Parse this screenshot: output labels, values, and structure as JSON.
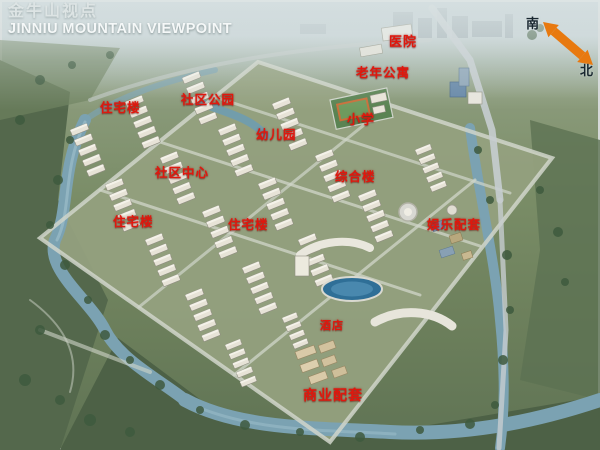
{
  "title": {
    "zh": "金牛山视点",
    "en": "JINNIU MOUNTAIN VIEWPOINT"
  },
  "compass": {
    "south": "南",
    "north": "北",
    "arrow_direction": "northwest-southeast double-headed"
  },
  "colors": {
    "label_red": "#e0170d",
    "arrow_orange": "#e8790f",
    "title_white": "#f5f8f8",
    "water_blue": "#7ba2b2",
    "pond_blue": "#2f6f97"
  },
  "labels": [
    {
      "id": "hospital",
      "text": "医院",
      "x": 389,
      "y": 31
    },
    {
      "id": "senior-apartments",
      "text": "老年公寓",
      "x": 356,
      "y": 62
    },
    {
      "id": "residential-north",
      "text": "住宅楼",
      "x": 100,
      "y": 97
    },
    {
      "id": "community-park",
      "text": "社区公园",
      "x": 181,
      "y": 89
    },
    {
      "id": "kindergarten",
      "text": "幼儿园",
      "x": 256,
      "y": 124
    },
    {
      "id": "elementary-school",
      "text": "小学",
      "x": 347,
      "y": 109
    },
    {
      "id": "community-center",
      "text": "社区中心",
      "x": 155,
      "y": 162
    },
    {
      "id": "mixed-use-building",
      "text": "综合楼",
      "x": 335,
      "y": 166
    },
    {
      "id": "residential-west",
      "text": "住宅楼",
      "x": 113,
      "y": 211
    },
    {
      "id": "residential-central",
      "text": "住宅楼",
      "x": 228,
      "y": 214
    },
    {
      "id": "entertainment",
      "text": "娱乐配套",
      "x": 427,
      "y": 214
    },
    {
      "id": "hotel",
      "text": "酒店",
      "x": 320,
      "y": 317
    },
    {
      "id": "commercial",
      "text": "商业配套",
      "x": 303,
      "y": 385
    }
  ]
}
